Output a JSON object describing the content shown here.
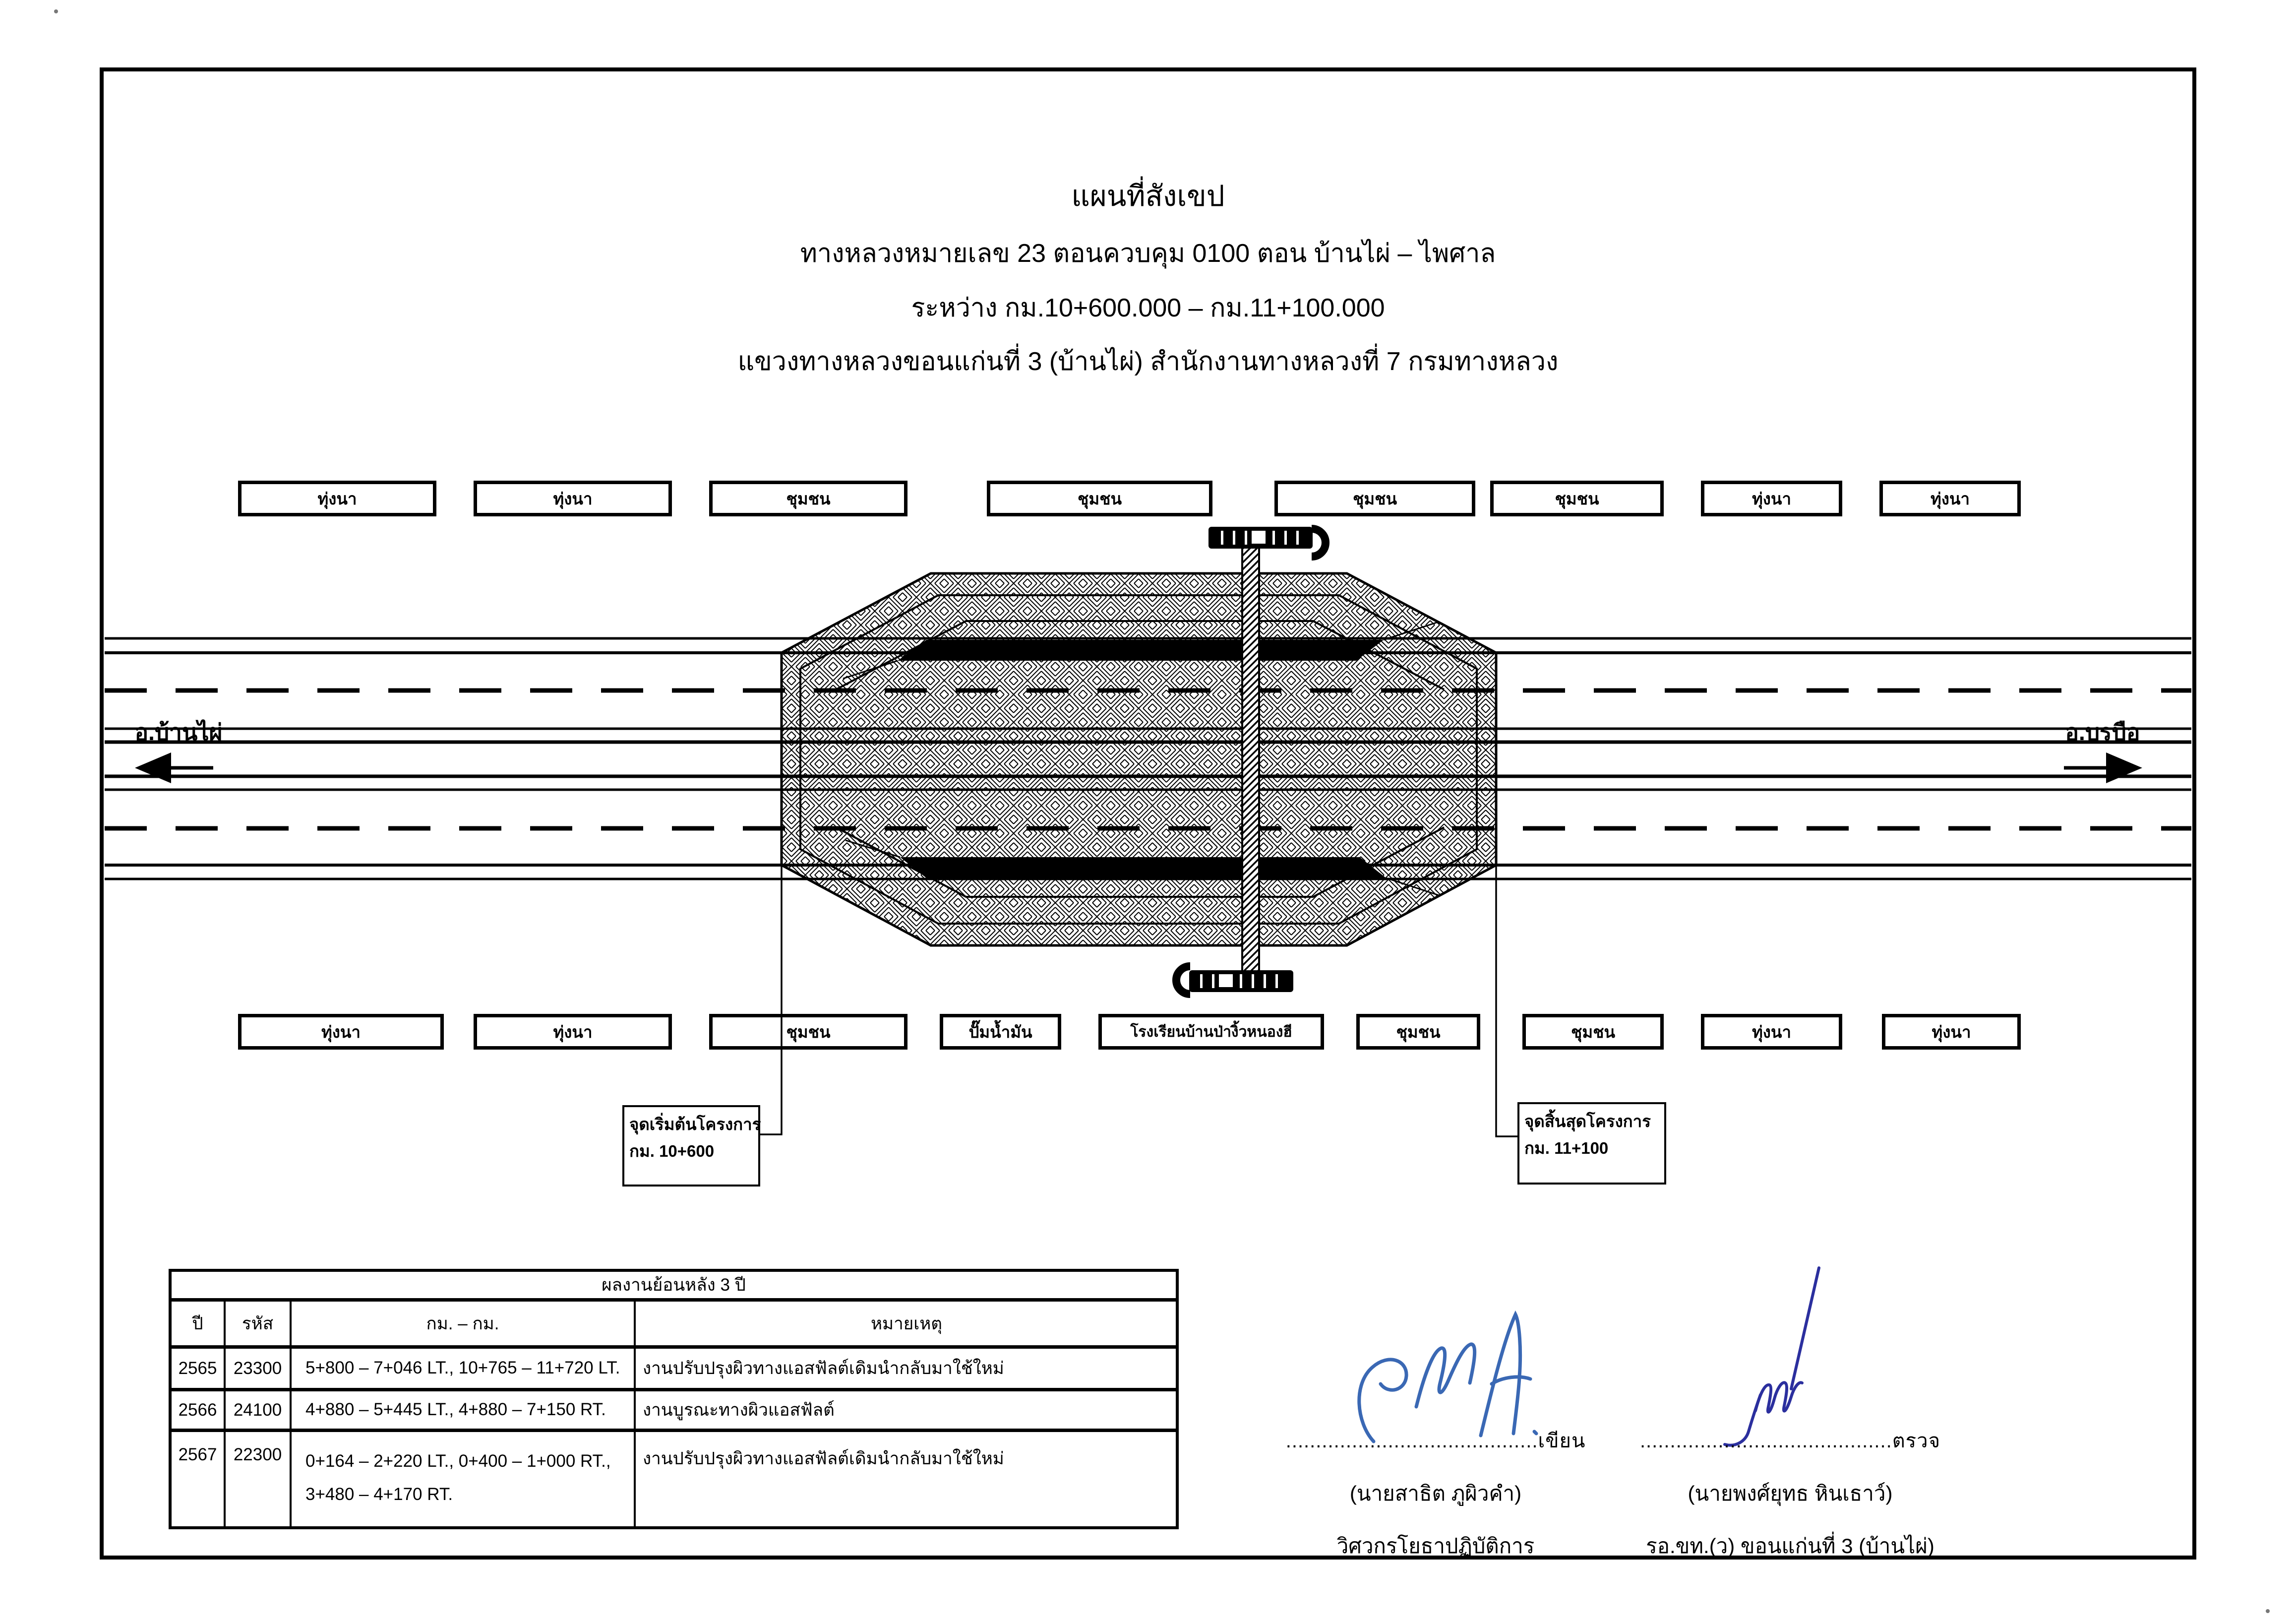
{
  "title": {
    "line1": "แผนที่สังเขป",
    "line2": "ทางหลวงหมายเลข  23   ตอนควบคุม 0100   ตอน  บ้านไผ่  –  ไพศาล",
    "line3": "ระหว่าง   กม.10+600.000  –  กม.11+100.000",
    "line4": "แขวงทางหลวงขอนแก่นที่ 3 (บ้านไผ่)   สำนักงานทางหลวงที่ 7  กรมทางหลวง"
  },
  "map": {
    "top_labels": [
      "ทุ่งนา",
      "ทุ่งนา",
      "ชุมชน",
      "ชุมชน",
      "ชุมชน",
      "ชุมชน",
      "ทุ่งนา",
      "ทุ่งนา"
    ],
    "bottom_labels": [
      "ทุ่งนา",
      "ทุ่งนา",
      "ชุมชน",
      "ปั๊มน้ำมัน",
      "โรงเรียนบ้านป่างิ้วหนองฮี",
      "ชุมชน",
      "ชุมชน",
      "ทุ่งนา",
      "ทุ่งนา"
    ],
    "left_destination": "อ.บ้านไผ่",
    "right_destination": "อ.บรบือ",
    "start_callout": {
      "line1": "จุดเริ่มต้นโครงการ",
      "line2": "กม. 10+600"
    },
    "end_callout": {
      "line1": "จุดสิ้นสุดโครงการ",
      "line2": "กม. 11+100"
    }
  },
  "history_table": {
    "title": "ผลงานย้อนหลัง 3 ปี",
    "headers": [
      "ปี",
      "รหัส",
      "กม. – กม.",
      "หมายเหตุ"
    ],
    "rows": [
      {
        "year": "2565",
        "code": "23300",
        "km": "5+800 – 7+046 LT., 10+765 – 11+720 LT.",
        "note": "งานปรับปรุงผิวทางแอสฟัลต์เดิมนำกลับมาใช้ใหม่"
      },
      {
        "year": "2566",
        "code": "24100",
        "km": "4+880 – 5+445 LT., 4+880 – 7+150 RT.",
        "note": "งานบูรณะทางผิวแอสฟัลต์"
      },
      {
        "year": "2567",
        "code": "22300",
        "km": "0+164 – 2+220 LT., 0+400 – 1+000 RT.,\n3+480 – 4+170 RT.",
        "note": "งานปรับปรุงผิวทางแอสฟัลต์เดิมนำกลับมาใช้ใหม่"
      }
    ]
  },
  "signatures": {
    "writer": {
      "dots": "..........................................",
      "label": "เขียน",
      "name": "(นายสาธิต  ภูผิวคำ)",
      "role": "วิศวกรโยธาปฏิบัติการ",
      "ink_color": "#3a68b4"
    },
    "inspector": {
      "dots": "..........................................",
      "label": "ตรวจ",
      "name": "(นายพงศ์ยุทธ  หินเธาว์)",
      "role": "รอ.ขท.(ว)  ขอนแก่นที่ 3 (บ้านไผ่)",
      "ink_color": "#2b2f9e"
    }
  },
  "colors": {
    "ink": "#000000",
    "paper": "#ffffff"
  }
}
